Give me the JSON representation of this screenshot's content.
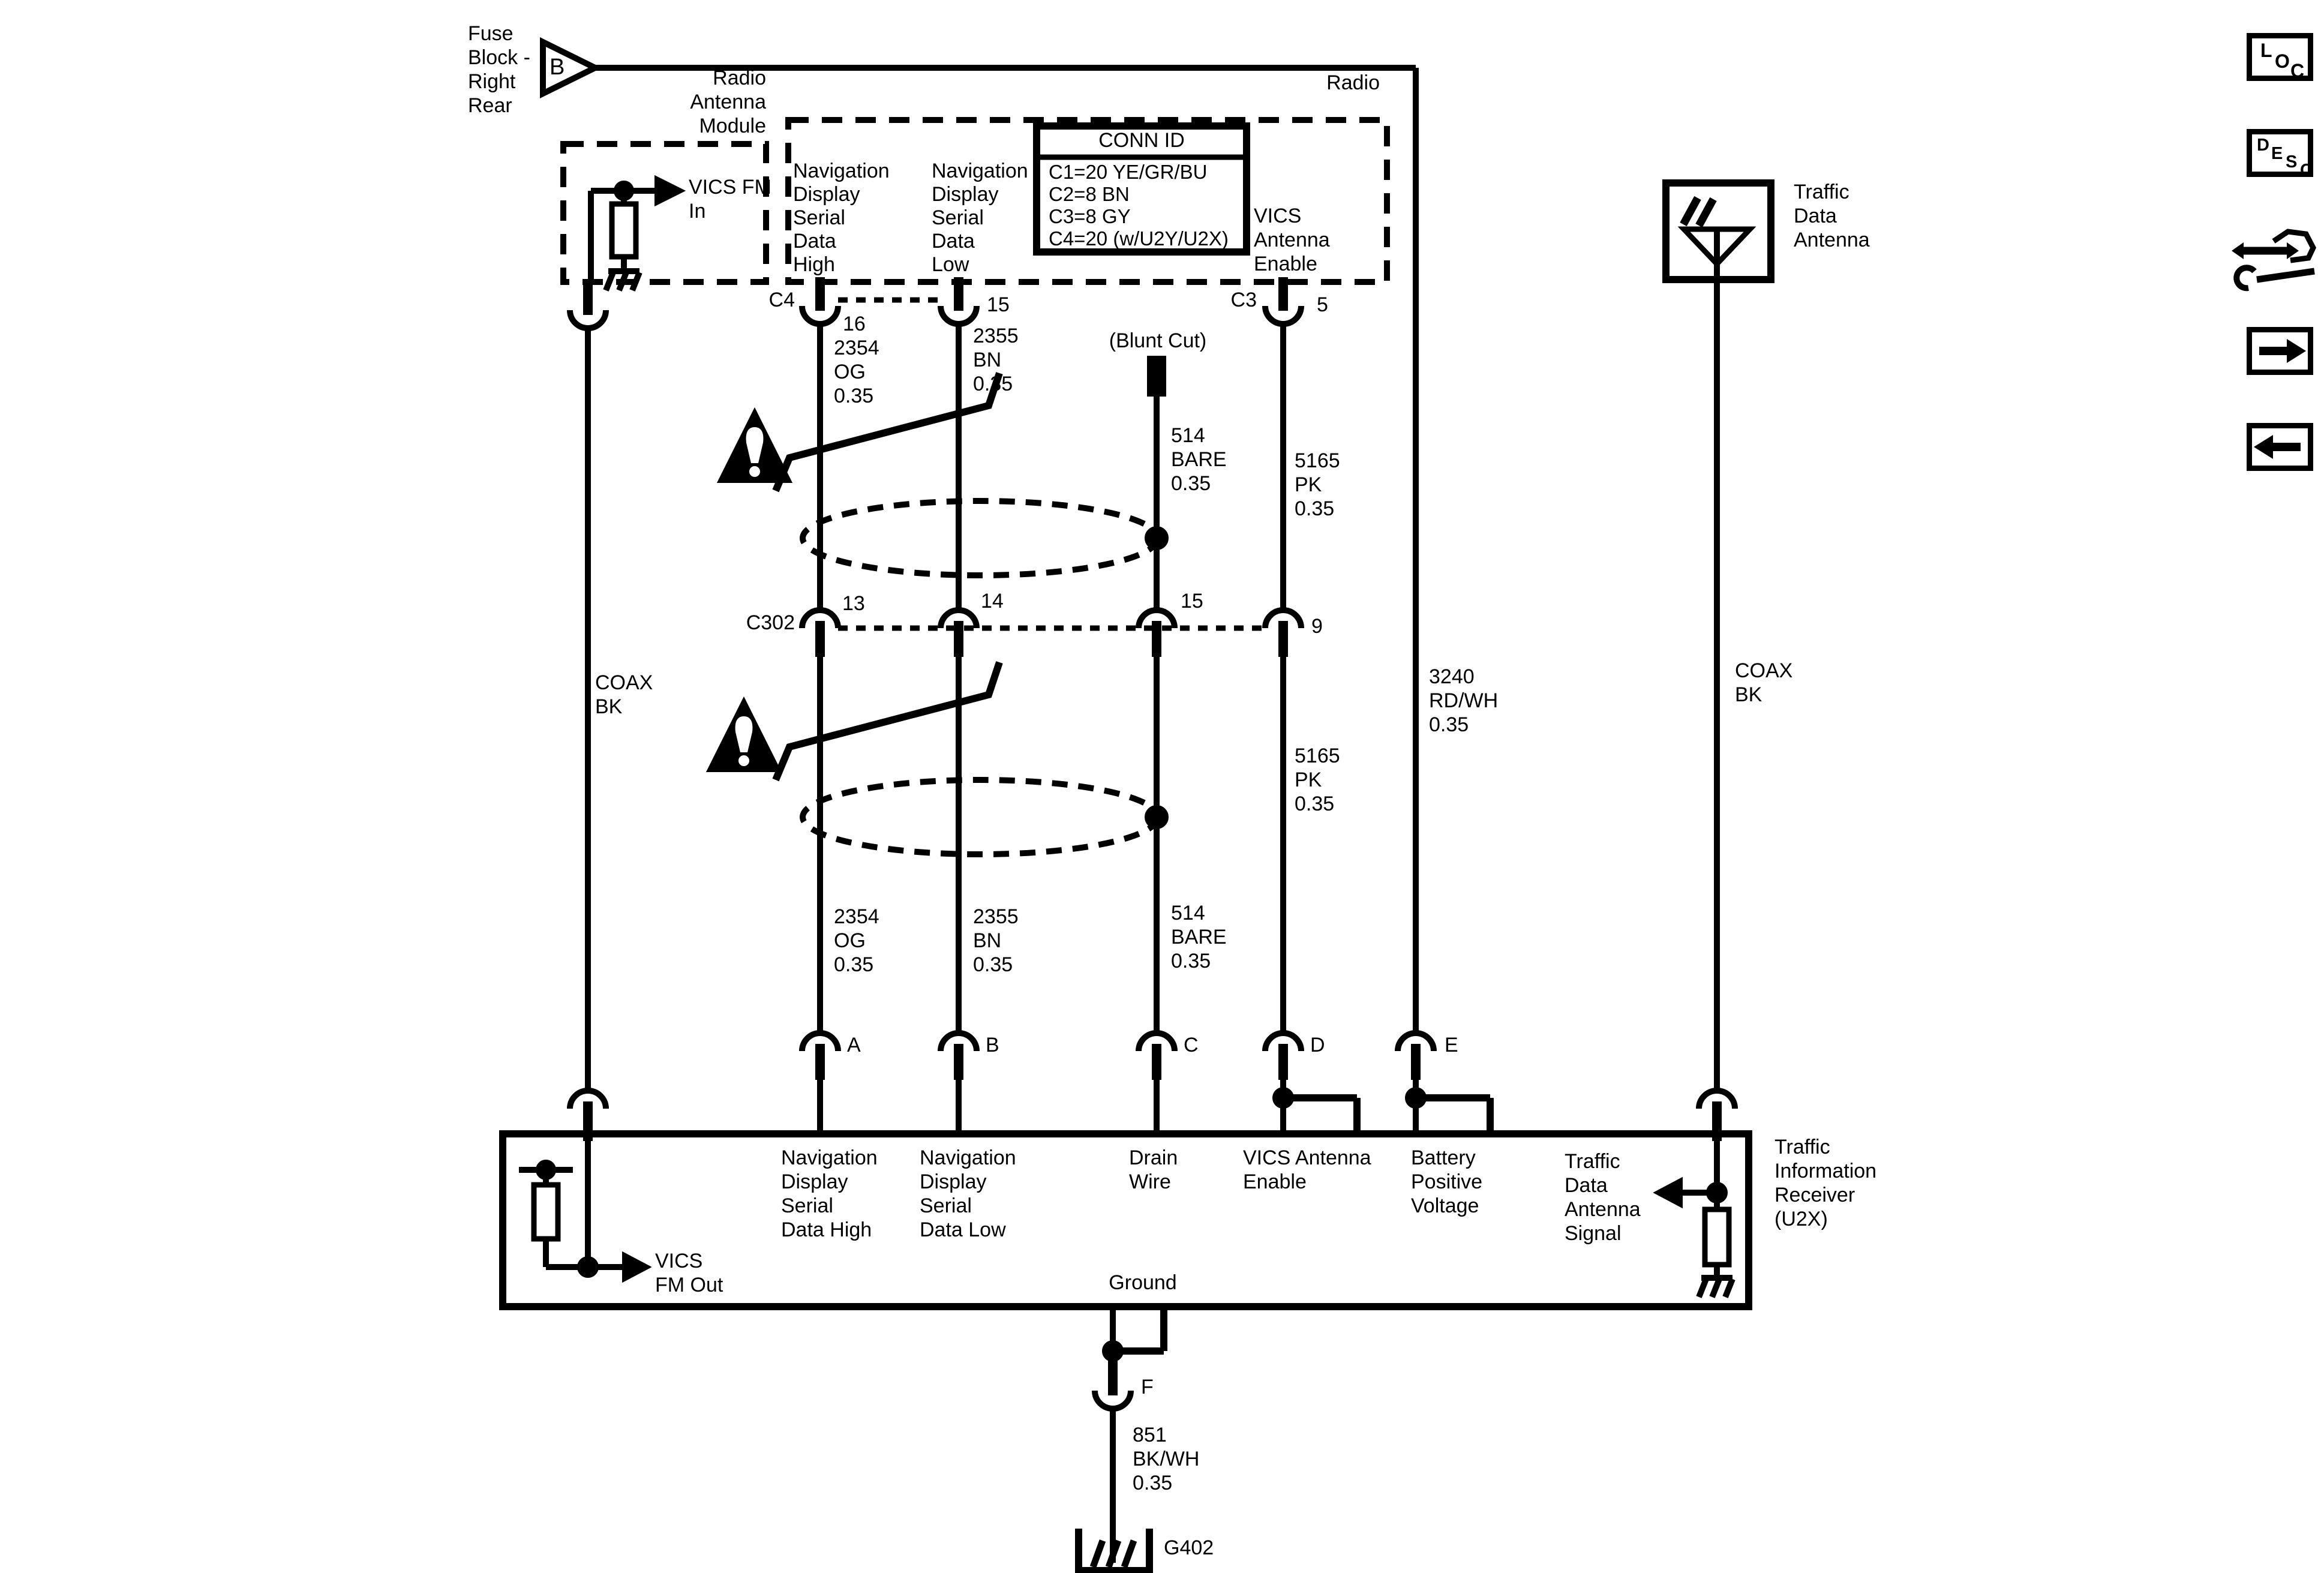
{
  "diagram": {
    "fuse_block": {
      "label": "Fuse\nBlock -\nRight\nRear",
      "pin": "B"
    },
    "radio_antenna_module": {
      "title": "Radio\nAntenna\nModule",
      "output": "VICS FM\nIn"
    },
    "radio": {
      "title": "Radio",
      "conn_id_table": {
        "title": "CONN ID",
        "rows": "C1=20 YE/GR/BU\nC2=8 BN\nC3=8 GY\nC4=20 (w/U2Y/U2X)"
      },
      "nav_high": "Navigation\nDisplay\nSerial\nData\nHigh",
      "nav_low": "Navigation\nDisplay\nSerial\nData\nLow",
      "vics_antenna_enable": "VICS\nAntenna\nEnable",
      "conn_c4": "C4",
      "pin_16": "16",
      "pin_15": "15",
      "conn_c3": "C3",
      "pin_5": "5"
    },
    "traffic_data_antenna": {
      "title": "Traffic\nData\nAntenna"
    },
    "wires": {
      "coax_left": "COAX\nBK",
      "coax_right": "COAX\nBK",
      "nav_high_upper": "2354\nOG\n0.35",
      "nav_low_upper": "2355\nBN\n0.35",
      "blunt_cut": "(Blunt Cut)",
      "drain_upper": "514\nBARE\n0.35",
      "vics_upper": "5165\nPK\n0.35",
      "battery": "3240\nRD/WH\n0.35",
      "nav_high_lower": "2354\nOG\n0.35",
      "nav_low_lower": "2355\nBN\n0.35",
      "drain_lower": "514\nBARE\n0.35",
      "vics_lower": "5165\nPK\n0.35",
      "ground": "851\nBK/WH\n0.35"
    },
    "c302": {
      "label": "C302",
      "pin_13": "13",
      "pin_14": "14",
      "pin_15": "15",
      "pin_9": "9"
    },
    "receiver": {
      "pins": {
        "a": "A",
        "b": "B",
        "c": "C",
        "d": "D",
        "e": "E",
        "f": "F"
      },
      "vics_fm_out": "VICS\nFM Out",
      "nav_high": "Navigation\nDisplay\nSerial\nData High",
      "nav_low": "Navigation\nDisplay\nSerial\nData Low",
      "drain": "Drain\nWire",
      "vics_antenna_enable": "VICS Antenna\nEnable",
      "battery": "Battery\nPositive\nVoltage",
      "traffic_signal": "Traffic\nData\nAntenna\nSignal",
      "ground": "Ground",
      "title": "Traffic\nInformation\nReceiver\n(U2X)"
    },
    "ground_ref": "G402"
  },
  "toolbar": {
    "loc": {
      "l": "L",
      "o": "O",
      "c": "C"
    },
    "desc": {
      "d": "D",
      "e": "E",
      "s": "S",
      "c": "C"
    }
  },
  "colors": {
    "line": "#000000",
    "background": "#ffffff"
  }
}
